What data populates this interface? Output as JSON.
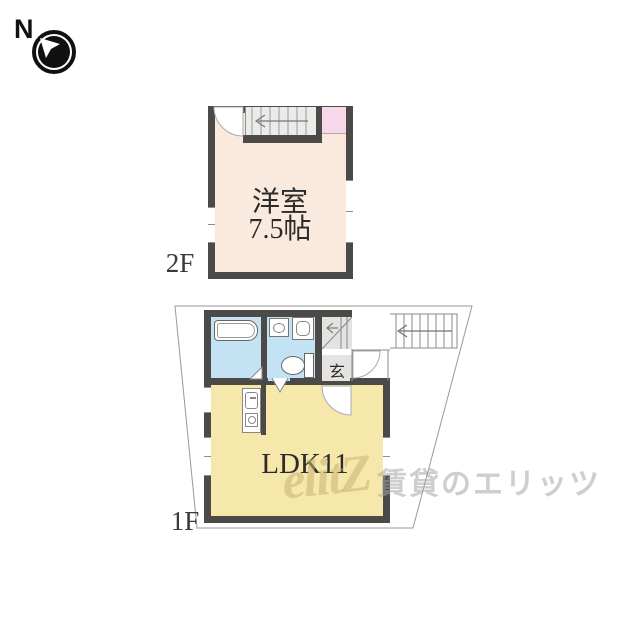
{
  "compass": {
    "label": "N"
  },
  "floor2": {
    "label": "2F",
    "room_name": "洋室",
    "room_size": "7.5帖"
  },
  "floor1": {
    "label": "1F",
    "room_name": "LDK11",
    "entrance_label": "玄"
  },
  "watermark": {
    "logo": "elitZ",
    "text": "賃貸のエリッツ"
  },
  "colors": {
    "wall": "#4b4a46",
    "room_cream": "#faeade",
    "room_yellow": "#f6e8aa",
    "wet_area_blue": "#c3e3f5",
    "closet_pink": "#f7d8ea",
    "entrance_gray": "#e4e3e1"
  }
}
